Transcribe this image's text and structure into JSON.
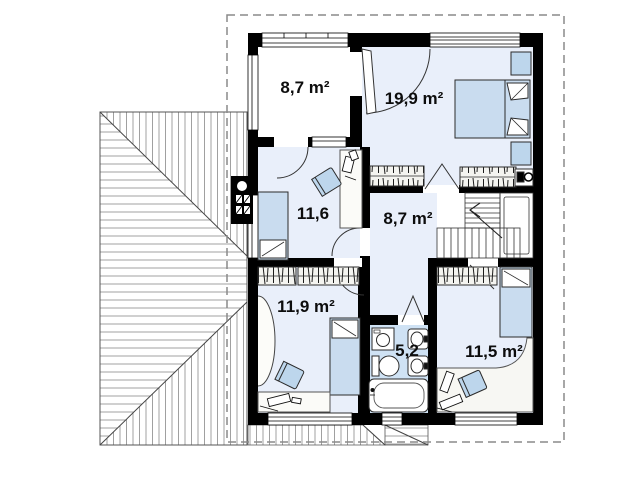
{
  "plan": {
    "rooms": [
      {
        "id": "balcony",
        "area_label": "8,7 m²"
      },
      {
        "id": "bedroom-1",
        "area_label": "19,9 m²"
      },
      {
        "id": "bedroom-2",
        "area_label": "11,6"
      },
      {
        "id": "hall",
        "area_label": "8,7 m²"
      },
      {
        "id": "bedroom-3",
        "area_label": "11,9 m²"
      },
      {
        "id": "bathroom",
        "area_label": "5,2"
      },
      {
        "id": "bedroom-4",
        "area_label": "11,5 m²"
      }
    ],
    "colors": {
      "wall": "#000000",
      "room_fill": "#e9effa",
      "bathroom_fill": "#cfe2f4",
      "furniture_fill": "#bdd6ec",
      "bed_fill": "#c9dcef",
      "boundary_dash": "#8a8a8a",
      "roof_hatch": "#969696"
    }
  }
}
